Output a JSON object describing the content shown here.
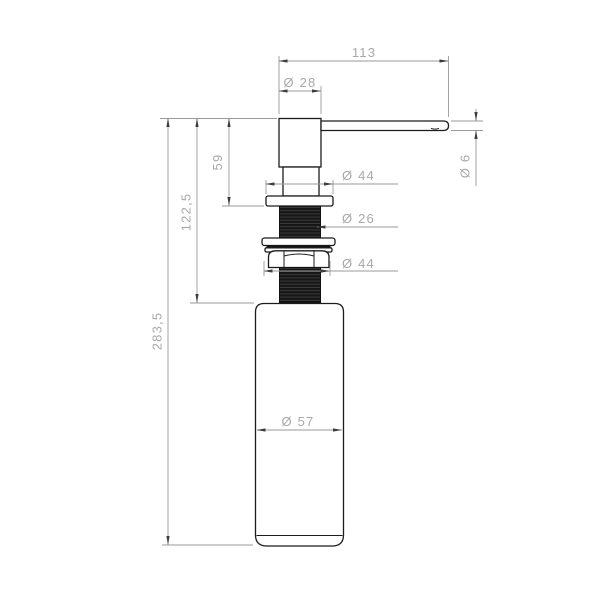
{
  "drawing": {
    "kind": "soap-dispenser-technical-drawing",
    "units_style": "millimetres, comma decimal separator",
    "labels": {
      "spout_length": "113",
      "head_diameter": "Ø 28",
      "head_to_flange": "59",
      "head_to_bottle_top": "122,5",
      "overall_height": "283,5",
      "flange_diameter": "Ø 44",
      "thread_diameter": "Ø 26",
      "locknut_diameter": "Ø 44",
      "bottle_diameter": "Ø 57",
      "spout_tip_diameter": "Ø 6"
    },
    "colors": {
      "background": "#ffffff",
      "part_outline": "#1c1c1c",
      "thread_fill": "#161616",
      "dimension_lines": "#9a9a9a",
      "dimension_text": "#a8a8a8",
      "arrowheads": "#3c3c3c"
    }
  }
}
